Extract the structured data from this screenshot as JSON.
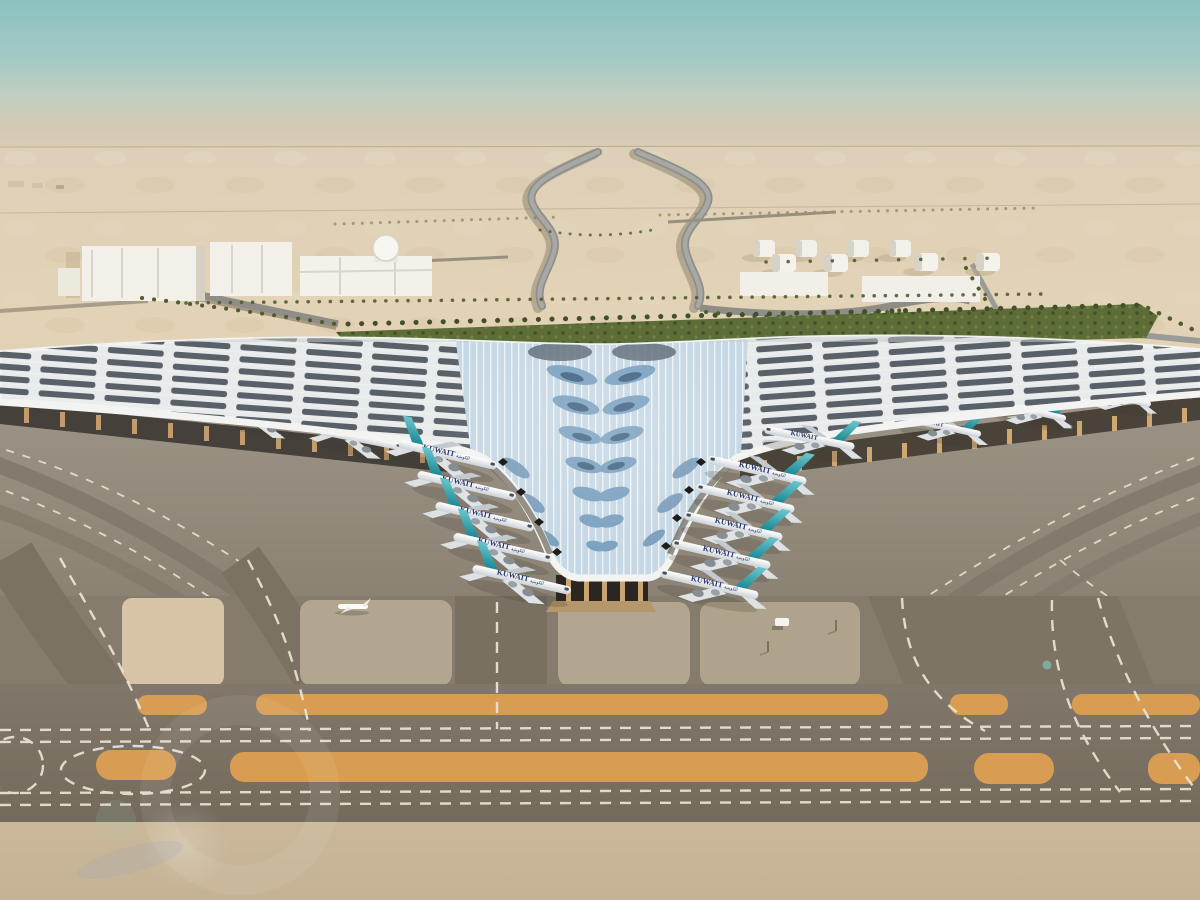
{
  "scene": {
    "description": "Aerial architectural rendering of a desert airport: a trefoil-shaped terminal with a white ribbed canopy roof covered in leaf-patterned blue solar panels, aircraft parked nose-in at both piers and along the central V, palm-lined approach roads, a fuel-tank farm, white warehouse buildings, and twin parallel taxiways with orange median strips in the foreground",
    "subject": "airport terminal in desert",
    "sky": "hazy teal fading to dusty beige at the horizon",
    "time_of_day": "daytime"
  },
  "labels": {
    "aircraft_title": "KUWAIT",
    "aircraft_title_arabic": "الكويتية"
  },
  "objects": {
    "aircraft_total": 20,
    "aircraft_left_pier": 5,
    "aircraft_left_v": 5,
    "aircraft_right_v": 6,
    "aircraft_right_pier": 4,
    "fuel_tanks": 8,
    "white_buildings": 6,
    "orange_taxiway_strips": 2,
    "small_aircraft_on_apron": 1,
    "ground_vehicles": 1
  },
  "palette": {
    "sky_top": "#8cc1c1",
    "sky_mid": "#a3c9c4",
    "sky_green": "#c1cfc0",
    "sky_haze": "#d5c9b2",
    "sky_horizon": "#ddd0b8",
    "sand_light": "#ded0b8",
    "sand_mid": "#e3d2b6",
    "sand_deep": "#d9c6a8",
    "sand_fore": "#c6b294",
    "apron_light": "#9c9486",
    "apron_dark": "#8b8274",
    "taxiway_dark": "#80776a",
    "taxiway_darker": "#746b5d",
    "strip_orange": "#d89d52",
    "roof_white": "#e8ebeb",
    "panel_dark": "#4d555e",
    "v_panel_light": "#c6d7e5",
    "v_panel_mid": "#7ba1c0",
    "v_panel_dark": "#3c5d7d",
    "tail_light": "#6ac7cc",
    "tail_dark": "#158290",
    "hedge_green": "#5d6d37",
    "building_white": "#f2f0e9",
    "marking_white": "#efe7d6",
    "title_navy": "#26356e",
    "shadow_warm": "#6b6254"
  }
}
